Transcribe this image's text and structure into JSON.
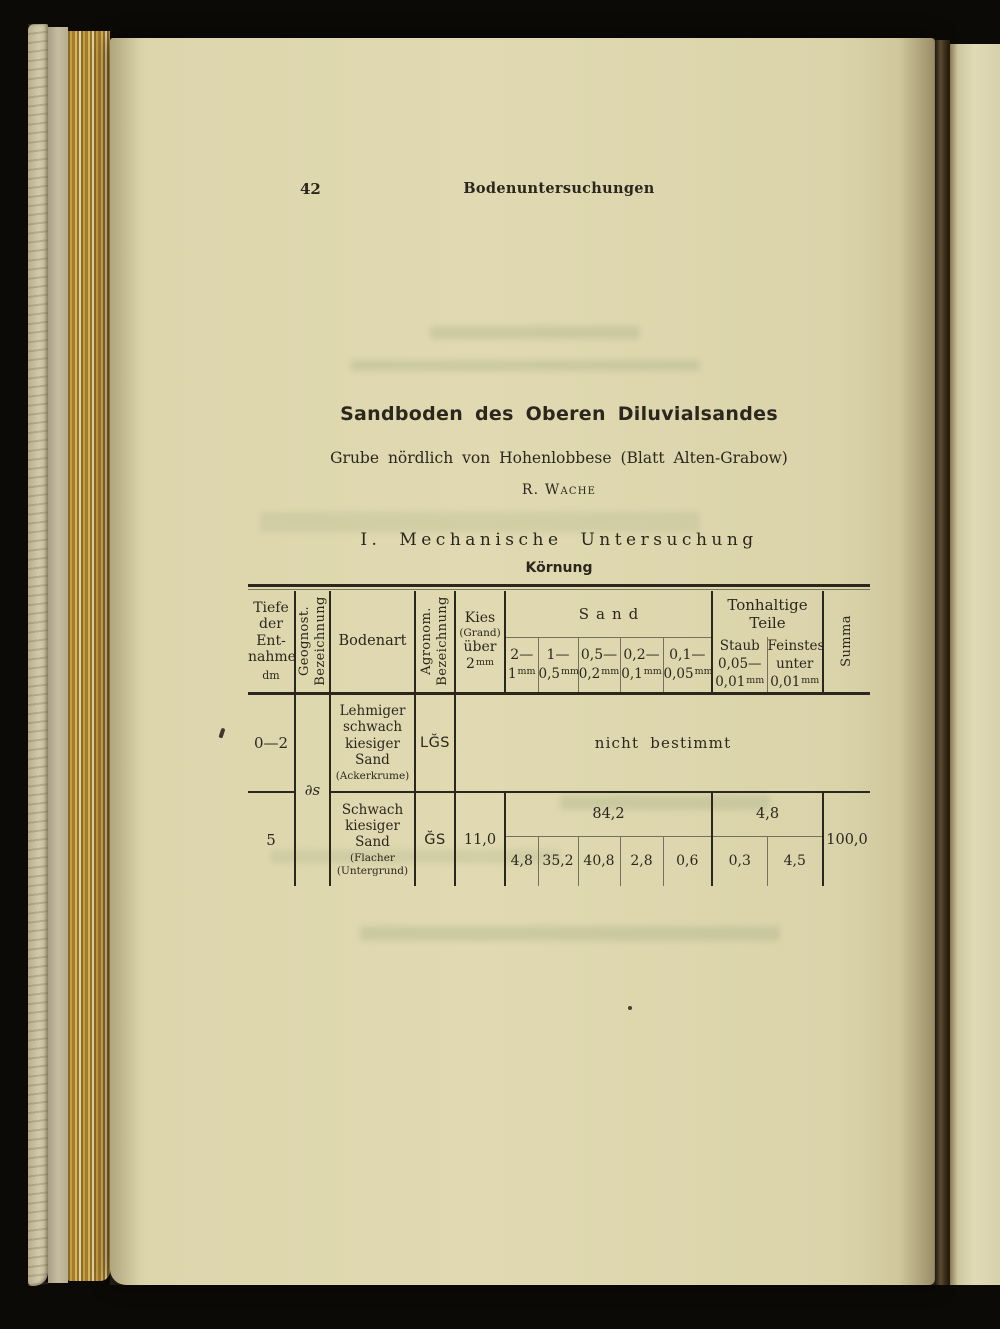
{
  "colors": {
    "paper": "#dcd5ab",
    "ink": "#2b271d"
  },
  "page": {
    "number": "42",
    "running_header": "Bodenuntersuchungen",
    "title": "Sandboden des Oberen Diluvialsandes",
    "subtitle": "Grube nördlich von Hohenlobbese (Blatt Alten-Grabow)",
    "author": "R. Wache",
    "section_heading": "I. Mechanische Untersuchung",
    "table_caption": "Körnung"
  },
  "table": {
    "header": {
      "tiefe_lines": "Tiefe\nder\nEnt-\nnahme",
      "tiefe_unit": "dm",
      "geognost": "Geognost.\nBezeichnung",
      "bodenart": "Bodenart",
      "agronom": "Agronom.\nBezeichnung",
      "kies_line1": "Kies",
      "kies_line2": "(Grand)",
      "kies_line3": "über",
      "kies_num": "2",
      "kies_unit": "mm",
      "sand": "Sand",
      "sand_sub": [
        {
          "top": "2—",
          "num": "1",
          "unit": "mm"
        },
        {
          "top": "1—",
          "num": "0,5",
          "unit": "mm"
        },
        {
          "top": "0,5—",
          "num": "0,2",
          "unit": "mm"
        },
        {
          "top": "0,2—",
          "num": "0,1",
          "unit": "mm"
        },
        {
          "top": "0,1—",
          "num": "0,05",
          "unit": "mm"
        }
      ],
      "ton": "Tonhaltige\nTeile",
      "staub_line1": "Staub",
      "staub_line2": "0,05—",
      "staub_num": "0,01",
      "staub_unit": "mm",
      "fein_line1": "Feinstes",
      "fein_line2": "unter",
      "fein_num": "0,01",
      "fein_unit": "mm",
      "summa": "Summa"
    },
    "rows": [
      {
        "tiefe": "0—2",
        "geognost": "∂s",
        "bodenart": "Lehmiger\nschwach\nkiesiger\nSand",
        "bodenart_note": "(Ackerkrume)",
        "agronom": "LĞS",
        "span_note": "nicht bestimmt"
      },
      {
        "tiefe": "5",
        "bodenart": "Schwach\nkiesiger\nSand",
        "bodenart_note": "(Flacher\n(Untergrund)",
        "agronom": "ĞS",
        "kies": "11,0",
        "sand_total": "84,2",
        "sand_values": [
          "4,8",
          "35,2",
          "40,8",
          "2,8",
          "0,6"
        ],
        "ton_total": "4,8",
        "ton_values": [
          "0,3",
          "4,5"
        ],
        "summa": "100,0"
      }
    ]
  }
}
